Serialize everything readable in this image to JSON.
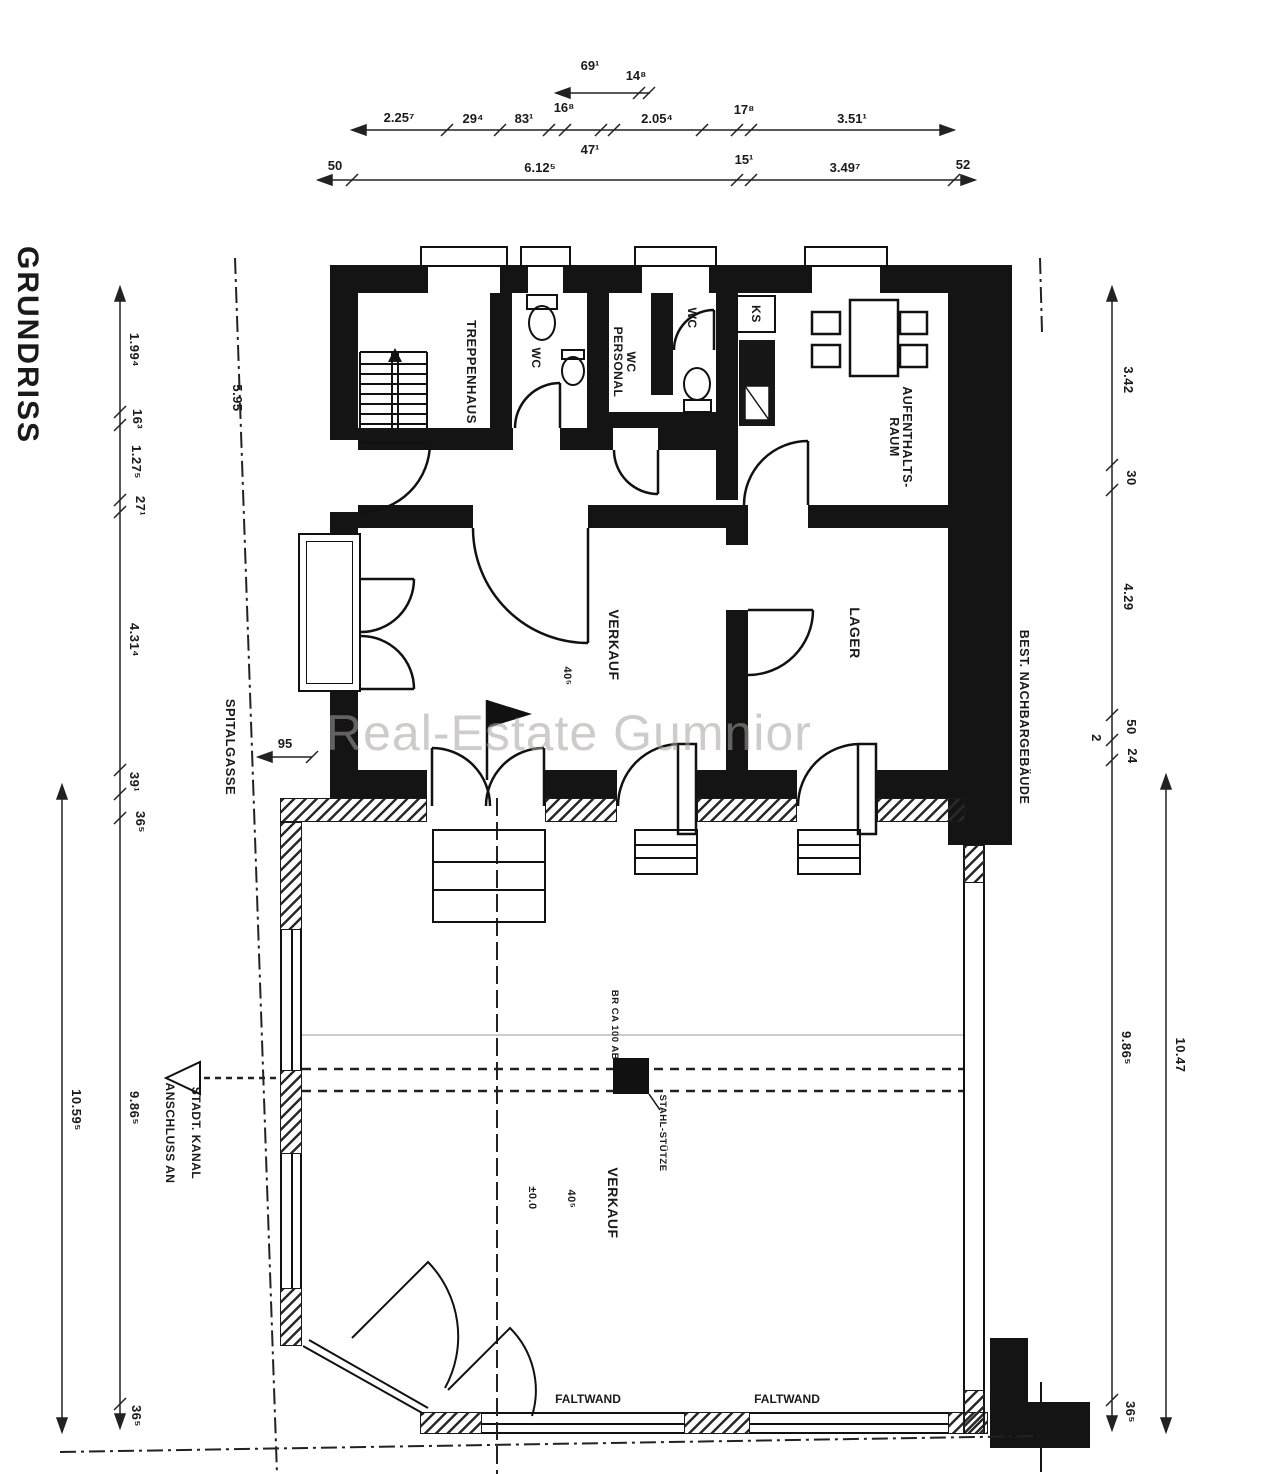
{
  "title": "GRUNDRISS",
  "watermark": "Real-Estate Gumnior",
  "dims_top": {
    "d69": "69¹",
    "d14": "14⁸",
    "d225": "2.25⁷",
    "d29": "29⁴",
    "d83": "83¹",
    "d16": "16⁸",
    "d205": "2.05⁴",
    "d17": "17⁸",
    "d351": "3.51¹",
    "d47": "47¹",
    "d50": "50",
    "d612": "6.12⁵",
    "d15": "15¹",
    "d349": "3.49⁷",
    "d52": "52"
  },
  "dims_left": {
    "d199": "1.99⁴",
    "d163": "16³",
    "d127": "1.27⁵",
    "d27": "27¹",
    "d431": "4.31⁴",
    "d39": "39¹",
    "d36a": "36⁵",
    "d986": "9.86⁵",
    "d36b": "36⁵",
    "d1059": "10.59⁵",
    "d95": "95",
    "d595": "5.95"
  },
  "dims_right": {
    "d342": "3.42",
    "d30": "30",
    "d429": "4.29",
    "d50": "50",
    "d24": "24",
    "d2": "2",
    "d986": "9.86⁵",
    "d1047": "10.47",
    "d36": "36⁵"
  },
  "rooms": {
    "treppenhaus": "TREPPENHAUS",
    "wc1": "WC",
    "wc_personal": "WC\nPERSONAL",
    "wc2": "WC",
    "ks": "KS",
    "aufenthaltsraum": "AUFENTHALTS-\nRAUM",
    "verkauf_upper": "VERKAUF",
    "lager": "LAGER",
    "verkauf_lower": "VERKAUF"
  },
  "annotations": {
    "spitalgasse": "SPITALGASSE",
    "nachbar": "BEST. NACHBARGEBÄUDE",
    "anschluss1": "ANSCHLUSS AN",
    "anschluss2": "STADT. KANAL",
    "faltwand1": "FALTWAND",
    "faltwand2": "FALTWAND",
    "br_ca": "BR CA 100 AB",
    "stuetze": "STAHL-STÜTZE",
    "level_upper": "40⁵",
    "level_lower_a": "±0.0",
    "level_lower_b": "40⁵"
  }
}
